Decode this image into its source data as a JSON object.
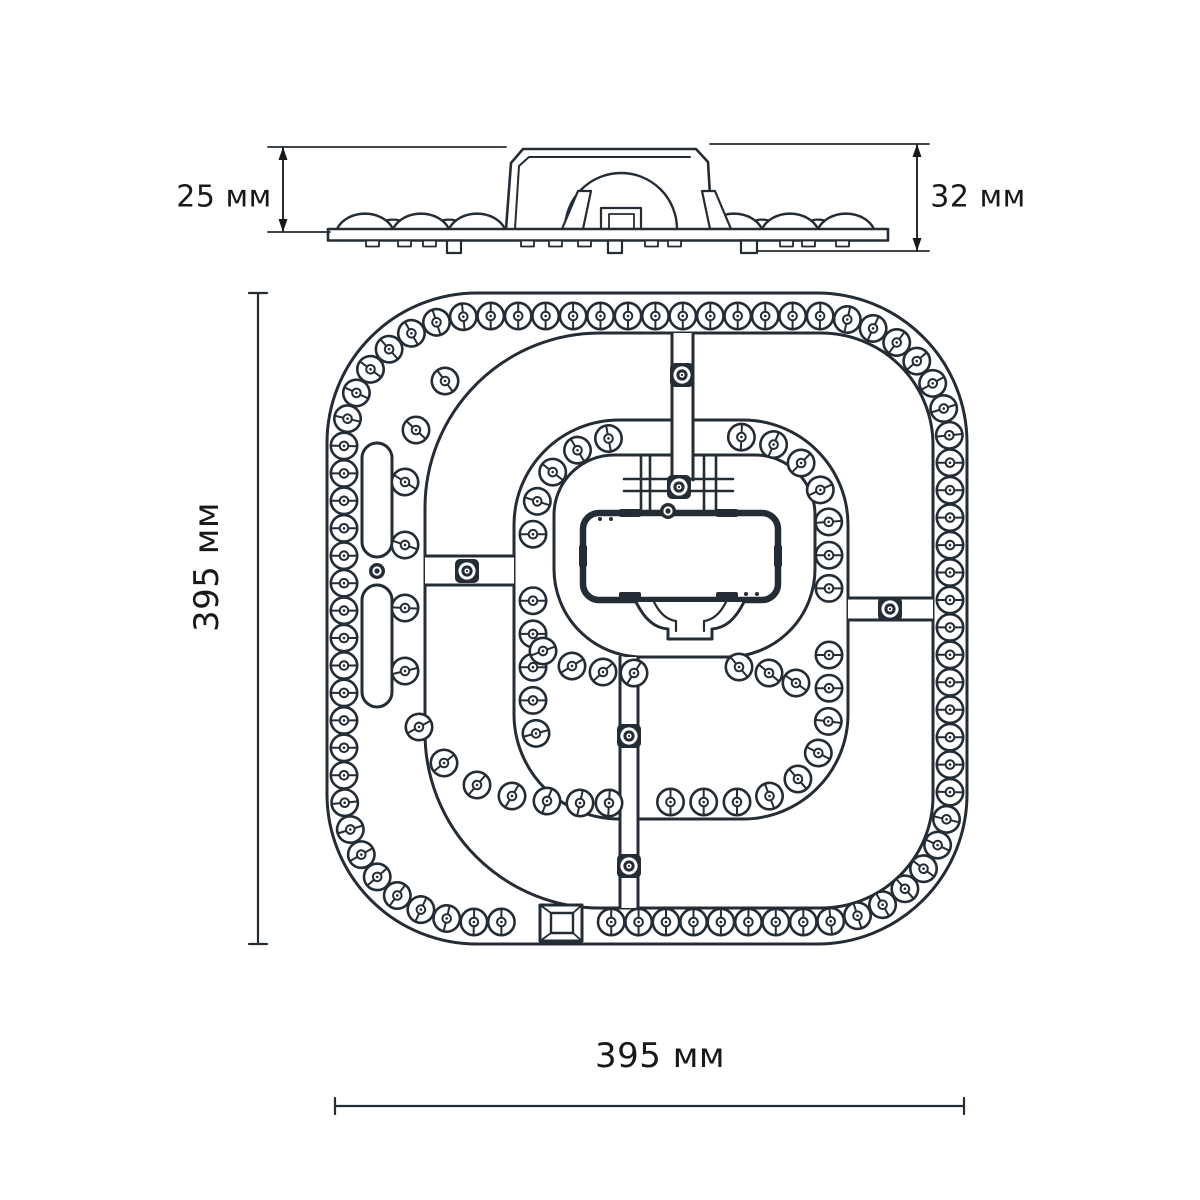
{
  "page": {
    "background": "#ffffff",
    "ink": "#242c35",
    "dim_ink": "#17191c"
  },
  "side_view": {
    "description": "LED module profile view",
    "left_dim": "25 мм",
    "right_dim": "32 мм"
  },
  "plan_view": {
    "description": "LED module top view",
    "vertical_dim": "395 мм",
    "horizontal_dim": "395 мм",
    "outer_ring_leds": 80,
    "inner_ring_leds": 35,
    "left_arc_leds": 14,
    "inner_bottom_leds": 7,
    "bridge_screws": 6,
    "small_screws": 2,
    "mount_slots": 2
  }
}
